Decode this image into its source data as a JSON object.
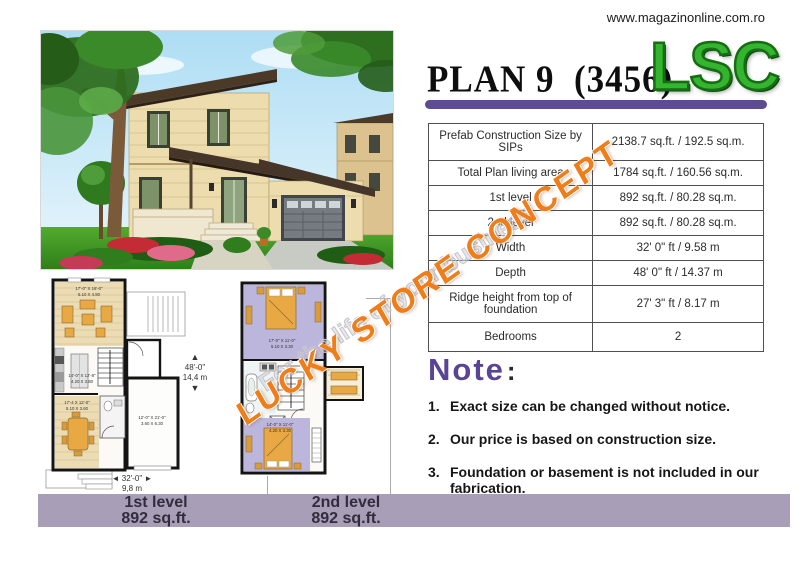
{
  "header": {
    "url": "www.magazinonline.com.ro",
    "title": "PLAN 9  (3456)",
    "logo": "LSC"
  },
  "colors": {
    "accent_purple": "#5e4b90",
    "note_purple": "#5a4496",
    "logo_green": "#35b42f",
    "watermark_orange": "#ee7d1a",
    "watermark_gray": "#c6c4cc",
    "footer_bar_mauve": "#a89eb8"
  },
  "spec_table": {
    "rows": [
      {
        "label": "Prefab Construction Size by SIPs",
        "value": "2138.7 sq.ft. / 192.5 sq.m."
      },
      {
        "label": "Total Plan living area",
        "value": "1784 sq.ft. / 160.56 sq.m."
      },
      {
        "label": "1st level",
        "value": "892 sq.ft. / 80.28 sq.m."
      },
      {
        "label": "2nd level",
        "value": "892 sq.ft. / 80.28 sq.m."
      },
      {
        "label": "Width",
        "value": "32' 0\" ft / 9.58 m"
      },
      {
        "label": "Depth",
        "value": "48' 0\" ft / 14.37 m"
      },
      {
        "label": "Ridge height from top of foundation",
        "value": "27' 3\" ft / 8.17 m"
      },
      {
        "label": "Bedrooms",
        "value": "2"
      }
    ]
  },
  "note": {
    "heading": "Note",
    "colon": ":",
    "items": [
      {
        "num": "1.",
        "text": "Exact size can be changed without notice."
      },
      {
        "num": "2.",
        "text": "Our price is based on construction size."
      },
      {
        "num": "3.",
        "text": "Foundation or basement is not included in our fabrication."
      }
    ]
  },
  "watermark": {
    "line1": "LUCKY STORE CONCEPT",
    "line2": "For the life of your business"
  },
  "plans": {
    "first": {
      "living_ft": "17'-0\" X 16'-0\"",
      "living_m": "5.10 X 4.80",
      "kitchen_ft": "14'-0\" X 12'-8\"",
      "kitchen_m": "4.20 X 3.80",
      "dining_ft": "17'-4 X 12'-0\"",
      "dining_m": "5.10 X 3.60",
      "garage_ft": "12'-0\" X 21'-0\"",
      "garage_m": "3.60 X 6.30"
    },
    "second": {
      "bed1_ft": "17'-0\" X 11'-0\"",
      "bed1_m": "5.10 X 3.30",
      "bed2_ft": "14'-0\" X 11'-0\"",
      "bed2_m": "4.20 X 3.30"
    },
    "dims": {
      "depth_ft": "48'-0\"",
      "depth_m": "14,4 m",
      "width_ft": "32'-0\"",
      "width_m": "9,8 m",
      "up_arrow": "▲",
      "down_arrow": "▼",
      "left_arrow": "◄",
      "right_arrow": "►"
    }
  },
  "footer": {
    "first": {
      "title": "1st level",
      "area": "892 sq.ft."
    },
    "second": {
      "title": "2nd level",
      "area": "892 sq.ft."
    }
  }
}
